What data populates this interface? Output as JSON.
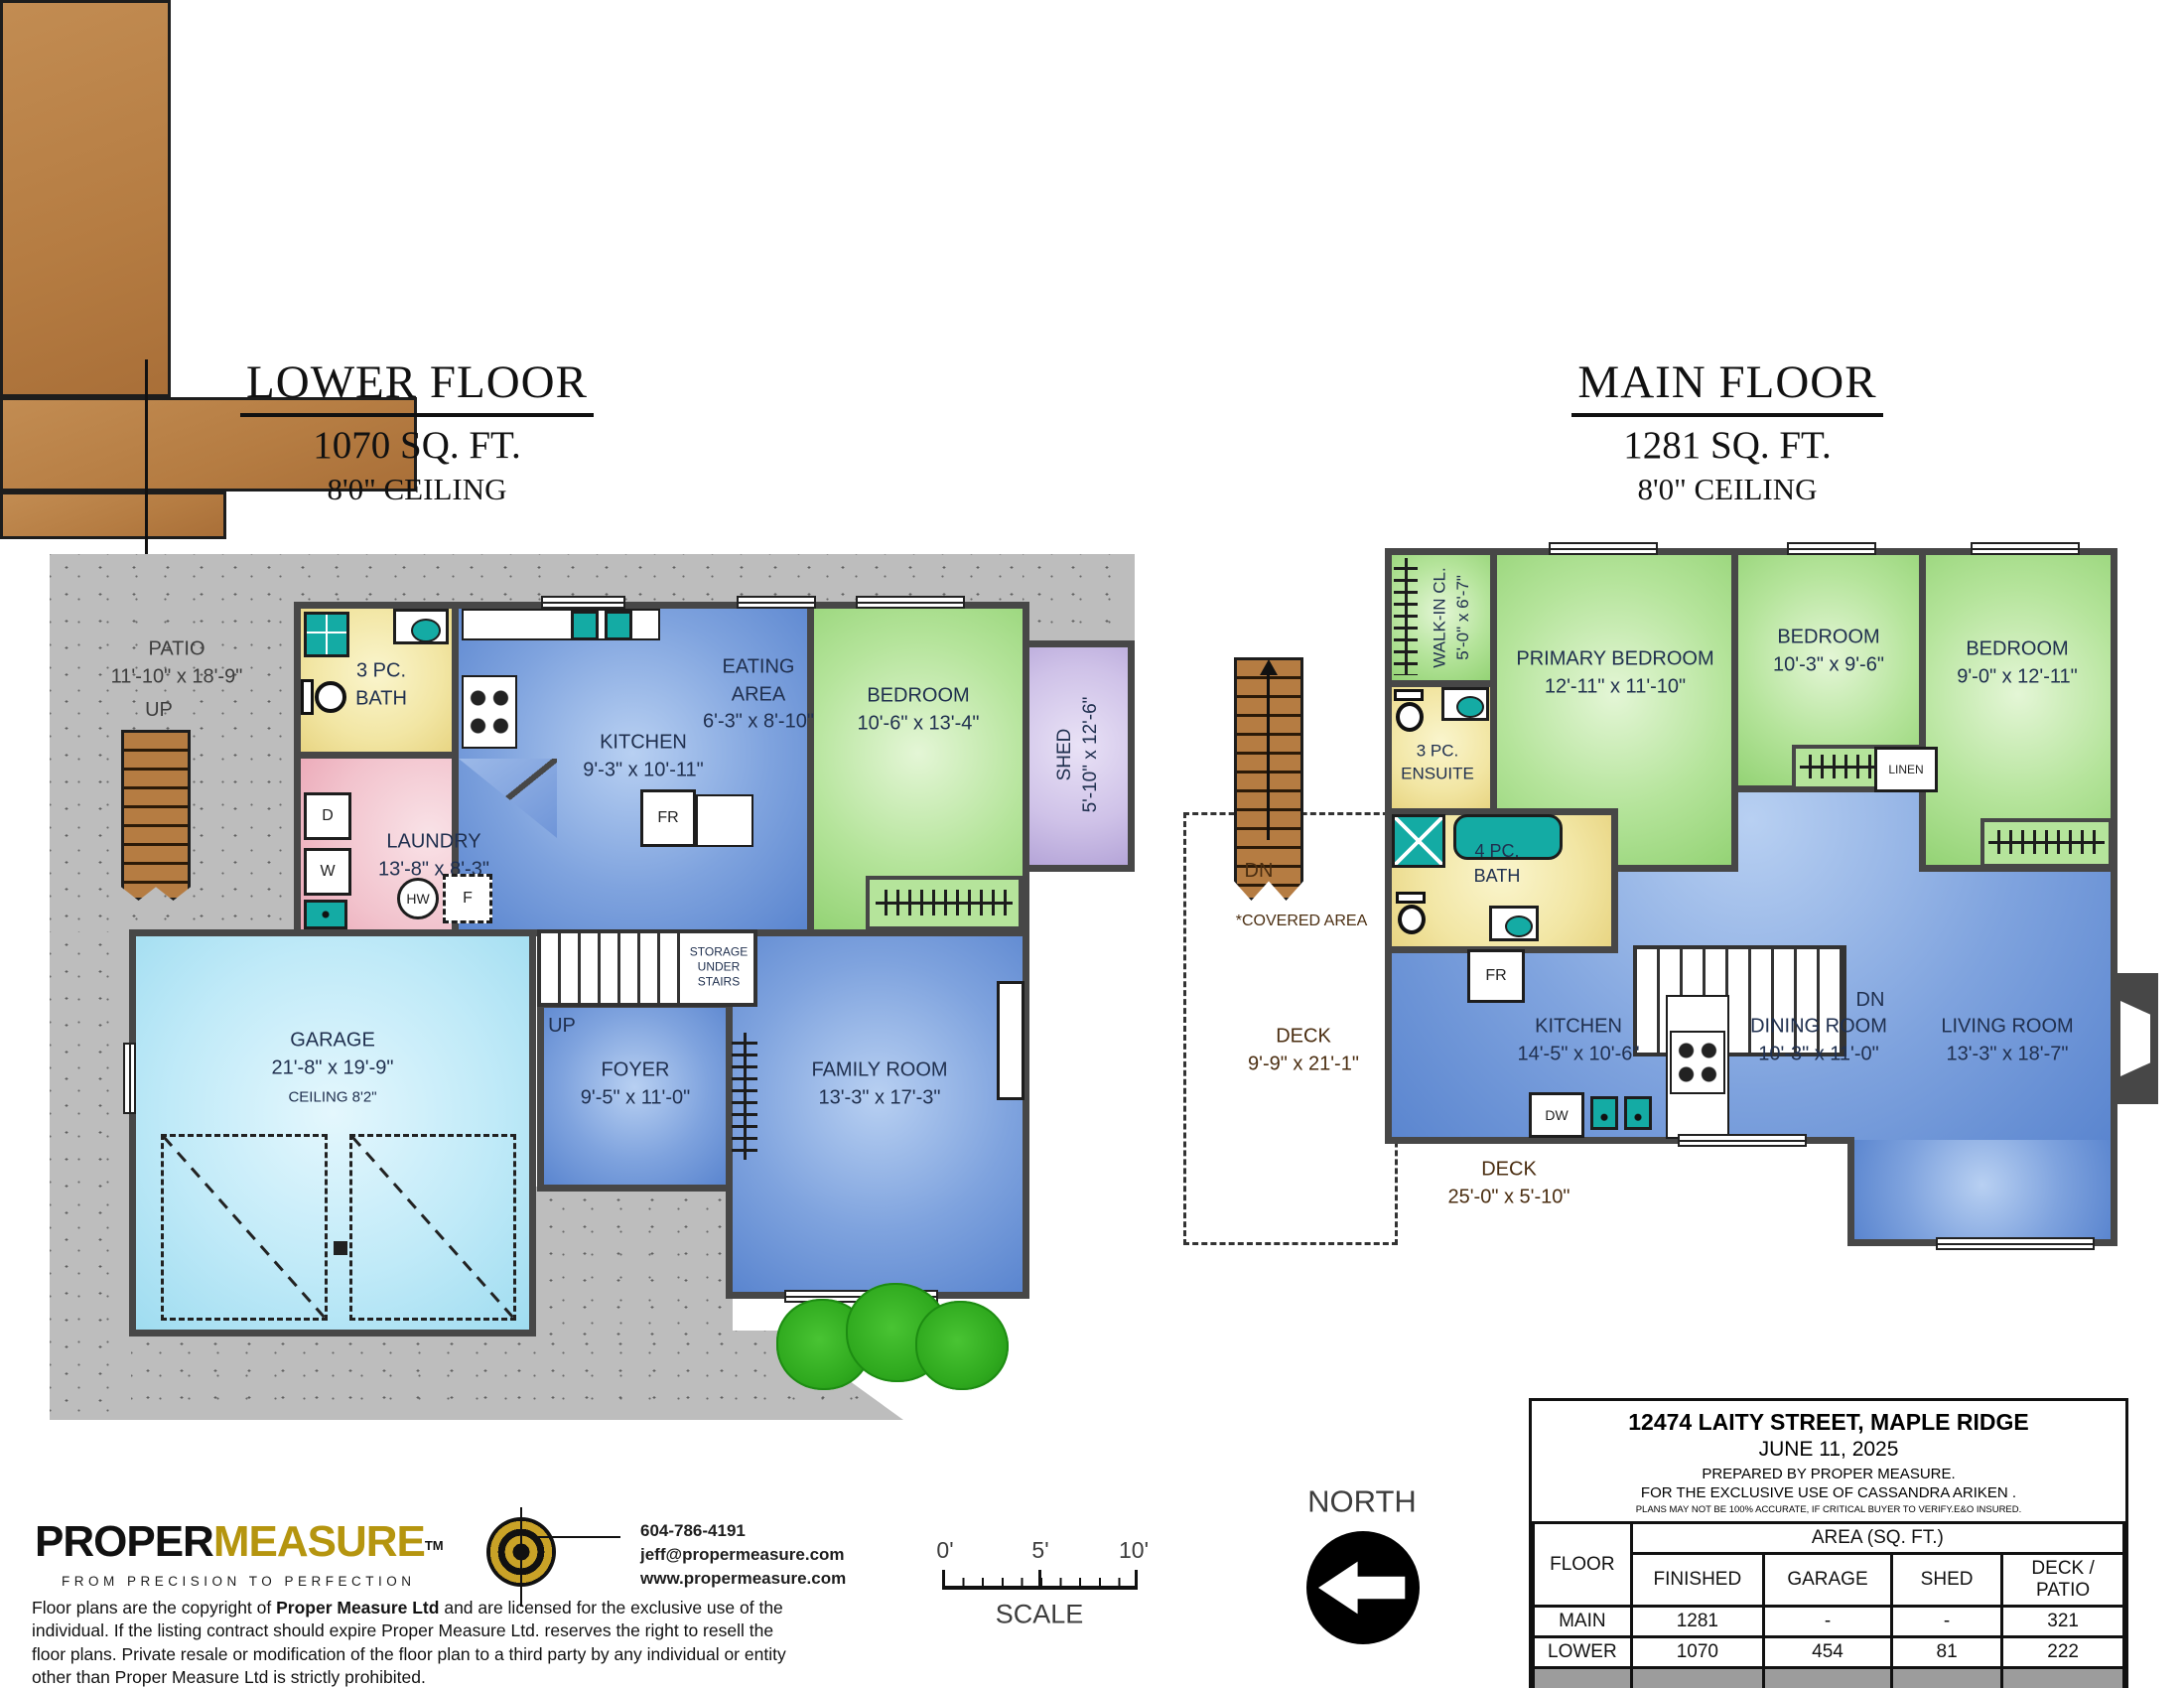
{
  "colors": {
    "wall": "#474747",
    "teal": "#14ABA4",
    "brand_gold": "#B5950F",
    "deck_brown": "#B57C42",
    "concrete": "#BDBDBD"
  },
  "lower": {
    "title": "LOWER FLOOR",
    "area": "1070 SQ. FT.",
    "ceiling": "8'0\" CEILING",
    "labels": {
      "patio": "PATIO\n11'-10\" x 18'-9\"",
      "up_patio": "UP",
      "up_foyer": "UP",
      "bath": "3 PC.\nBATH",
      "laundry": "LAUNDRY\n13'-8\" x 8'-3\"",
      "kitchen": "KITCHEN\n9'-3\" x 10'-11\"",
      "eating": "EATING\nAREA\n6'-3\" x 8'-10\"",
      "bedroom": "BEDROOM\n10'-6\" x 13'-4\"",
      "shed": "SHED\n5'-10\" x 12'-6\"",
      "garage": "GARAGE\n21'-8\" x 19'-9\"",
      "garage_ceiling": "CEILING 8'2\"",
      "storage": "STORAGE\nUNDER\nSTAIRS",
      "foyer": "FOYER\n9'-5\" x 11'-0\"",
      "family": "FAMILY ROOM\n13'-3\" x 17'-3\""
    },
    "appliances": {
      "d": "D",
      "w": "W",
      "hw": "HW",
      "f": "F",
      "fr": "FR"
    }
  },
  "main": {
    "title": "MAIN FLOOR",
    "area": "1281 SQ. FT.",
    "ceiling": "8'0\" CEILING",
    "labels": {
      "walkin": "WALK-IN CL.\n5'-0\" x 6'-7\"",
      "primary": "PRIMARY BEDROOM\n12'-11\" x 11'-10\"",
      "bedroom2": "BEDROOM\n10'-3\" x 9'-6\"",
      "bedroom3": "BEDROOM\n9'-0\" x 12'-11\"",
      "ensuite": "3 PC.\nENSUITE",
      "bath": "4 PC.\nBATH",
      "linen": "LINEN",
      "kitchen": "KITCHEN\n14'-5\" x 10'-6\"",
      "dining": "DINING ROOM\n10'-3\" x 11'-0\"",
      "living": "LIVING ROOM\n13'-3\" x 18'-7\"",
      "deck_side": "DECK\n9'-9\" x 21'-1\"",
      "covered": "*COVERED AREA",
      "deck_bottom": "DECK\n25'-0\" x 5'-10\"",
      "dn_exterior": "DN",
      "dn_interior": "DN"
    },
    "appliances": {
      "fr": "FR",
      "dw": "DW"
    }
  },
  "footer": {
    "logo": {
      "part1": "PROPER",
      "part2": "MEASURE",
      "tm": "TM",
      "tagline": "FROM PRECISION TO PERFECTION"
    },
    "contact": {
      "phone": "604-786-4191",
      "email": "jeff@propermeasure.com",
      "web": "www.propermeasure.com"
    },
    "copyright": {
      "pre": "Floor plans are the copyright of ",
      "bold": "Proper Measure Ltd",
      "post": " and are licensed for the exclusive use of the individual.  If the listing contract should expire Proper Measure Ltd. reserves the right to resell the floor plans.  Private resale or modification of the floor plan to a third party by any individual or entity other than Proper Measure Ltd is strictly prohibited."
    },
    "scale": {
      "t0": "0'",
      "t5": "5'",
      "t10": "10'",
      "label": "SCALE"
    },
    "north": "NORTH"
  },
  "info_table": {
    "address": "12474 LAITY STREET, MAPLE RIDGE",
    "date": "JUNE 11, 2025",
    "prepared": "PREPARED BY PROPER MEASURE.",
    "exclusive": "FOR THE EXCLUSIVE USE OF CASSANDRA ARIKEN .",
    "disclaimer": "PLANS MAY NOT BE 100% ACCURATE, IF CRITICAL BUYER TO VERIFY.E&O INSURED.",
    "floor_col": "FLOOR",
    "area_header": "AREA (SQ. FT.)",
    "cols": [
      "FINISHED",
      "GARAGE",
      "SHED",
      "DECK / PATIO"
    ],
    "rows": [
      {
        "floor": "MAIN",
        "finished": "1281",
        "garage": "-",
        "shed": "-",
        "deck": "321"
      },
      {
        "floor": "LOWER",
        "finished": "1070",
        "garage": "454",
        "shed": "81",
        "deck": "222"
      }
    ],
    "total": {
      "floor": "TOTAL",
      "finished": "2351",
      "garage": "454",
      "shed": "81",
      "deck": "543"
    }
  }
}
